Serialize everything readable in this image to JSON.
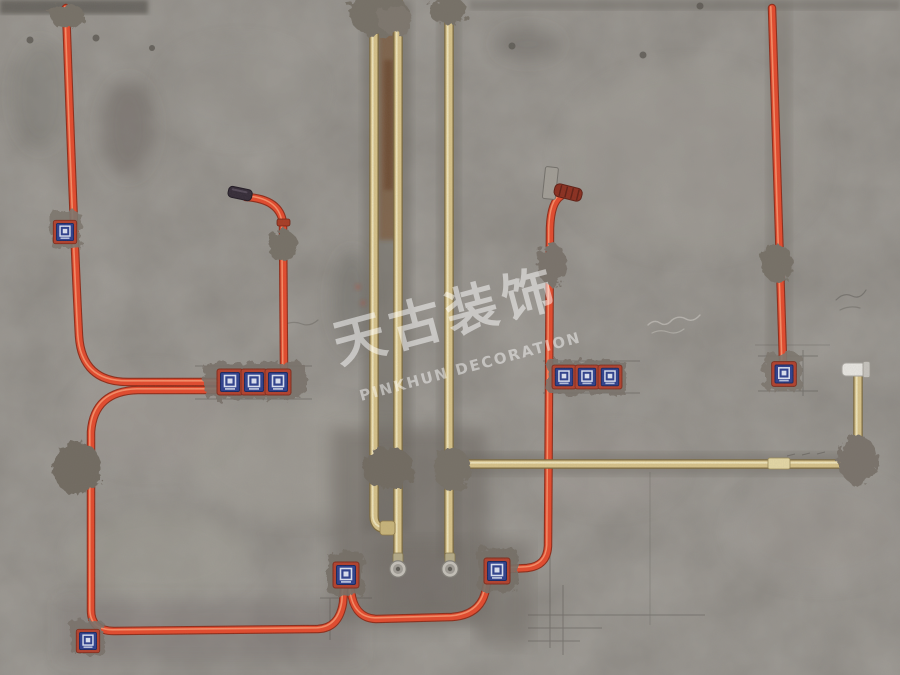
{
  "watermark": {
    "chinese": "天古装饰",
    "english": "PINKHUN DECORATION"
  },
  "scene": {
    "junction_box_count": 11,
    "colors": {
      "wall_base": "#8a8680",
      "red_conduit": "#e6492b",
      "yellow_pipe": "#d8c389",
      "box_face_blue": "#2c3f8e",
      "box_frame_red": "#b43f2b",
      "box_logo_white": "#dde3f4",
      "mortar_patch": "#79726a",
      "pencil_mark": "#4f4c47",
      "cap_silver": "#c6c2ba",
      "rust_stain": "#7c4e2a"
    }
  }
}
